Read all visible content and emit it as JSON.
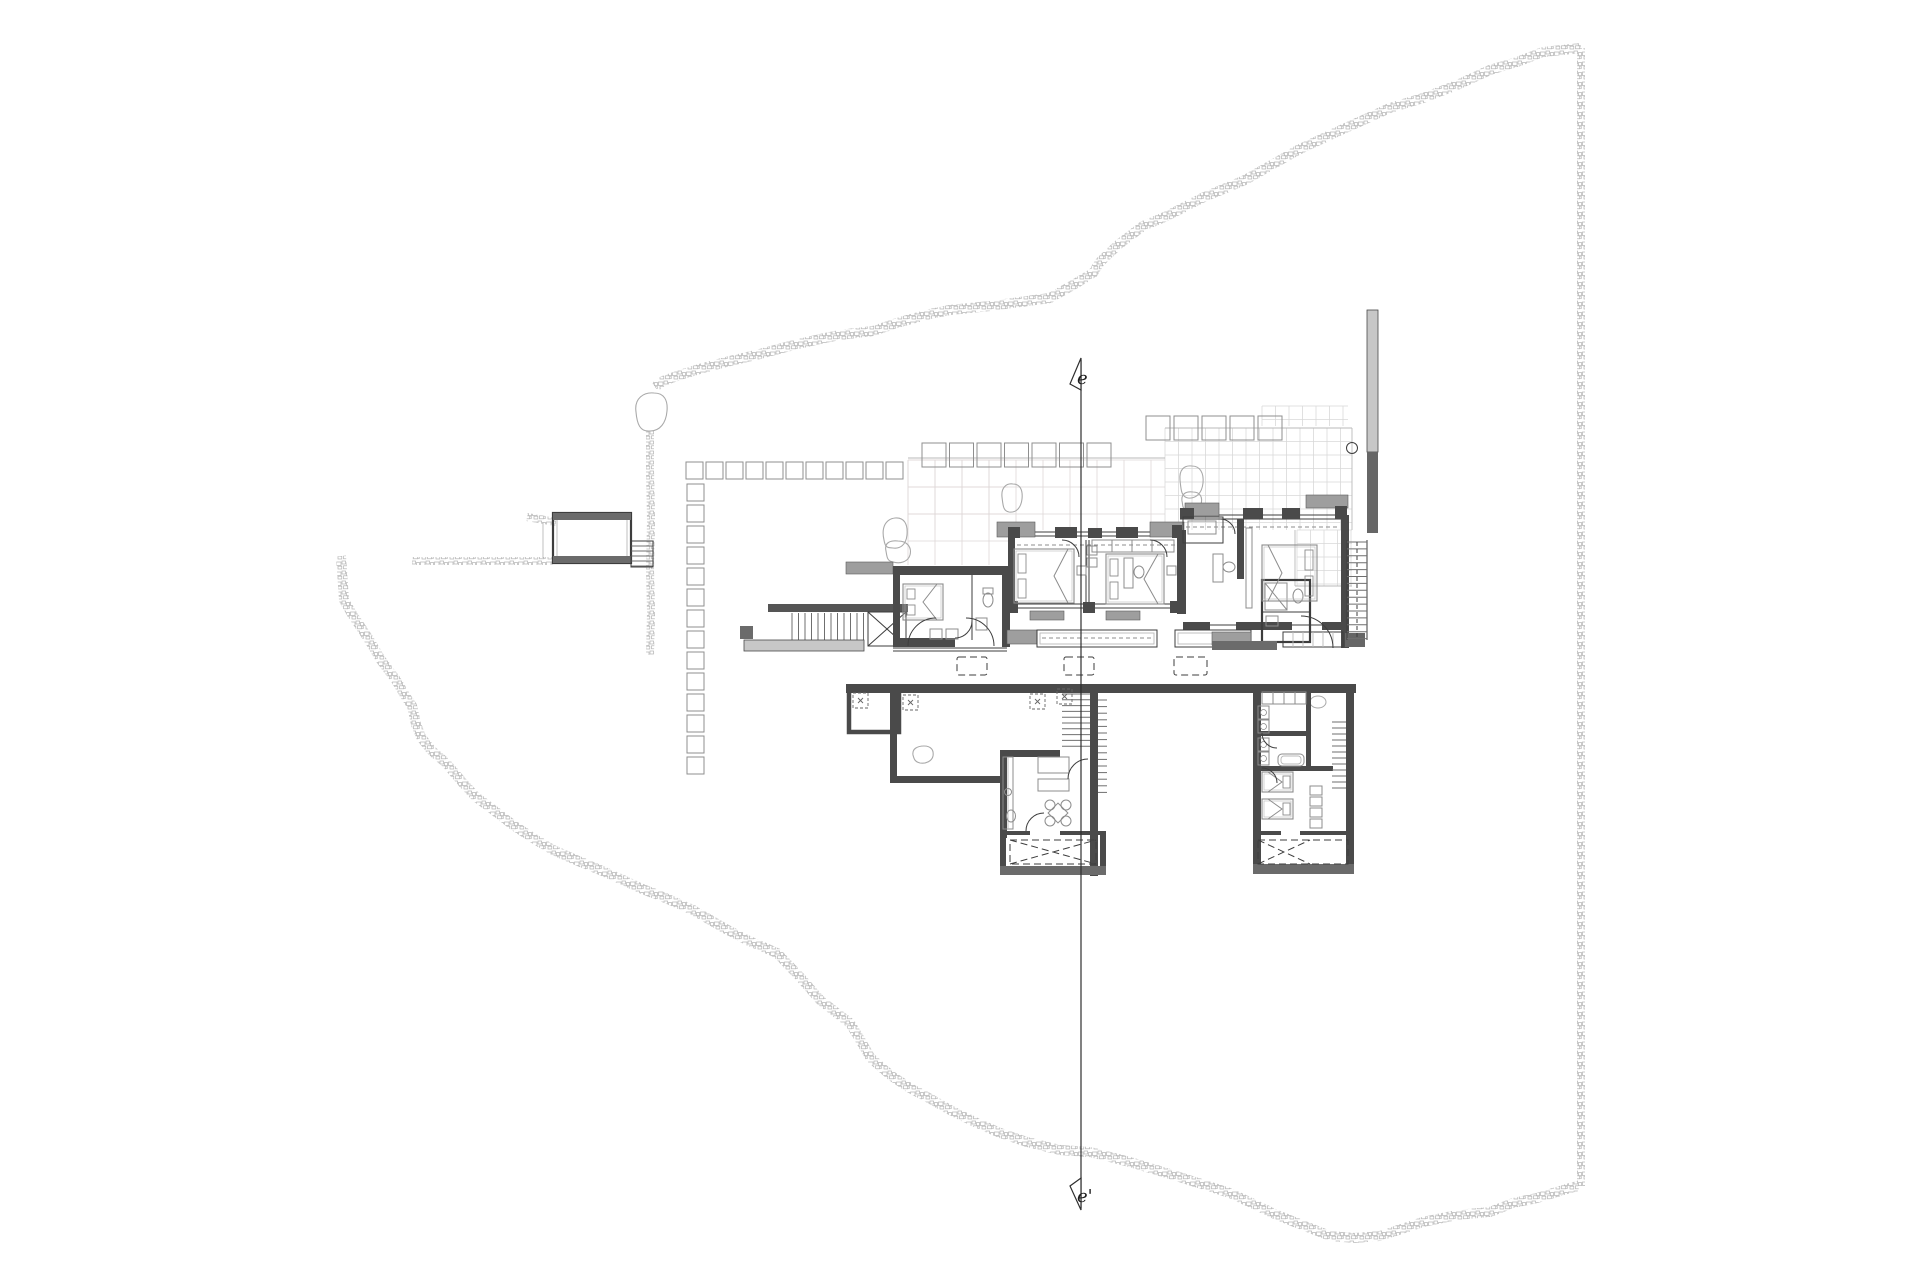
{
  "drawing": {
    "kind": "architectural-site-and-floor-plan",
    "section_markers": {
      "top": "e",
      "bottom": "e'"
    },
    "colors": {
      "paper": "#ffffff",
      "ink": "#3d3d3d",
      "wall": "#4a4a4a",
      "gray_dark": "#6b6b6b",
      "gray_mid": "#9e9e9e",
      "gray_light": "#c7c7c7",
      "stone": "#b3b3b3",
      "grid_faint": "#ded7d7",
      "grid_line": "#d9d9d9",
      "furn": "#8c8c8c",
      "boulder": "#a9a9a9",
      "section": "#2e2e2e"
    }
  }
}
